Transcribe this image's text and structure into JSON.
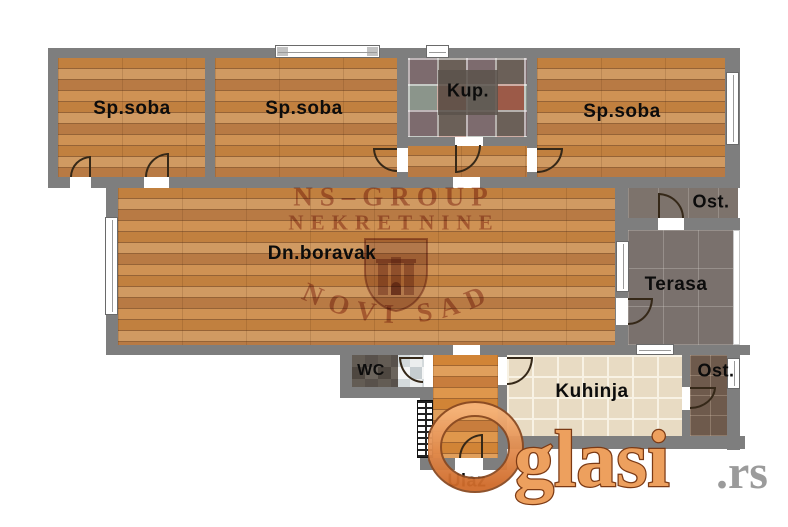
{
  "rooms": [
    {
      "id": "bedroom-1",
      "label": "Sp.soba"
    },
    {
      "id": "bedroom-2",
      "label": "Sp.soba"
    },
    {
      "id": "bathroom",
      "label": "Kup."
    },
    {
      "id": "bedroom-3",
      "label": "Sp.soba"
    },
    {
      "id": "living-room",
      "label": "Dn.boravak"
    },
    {
      "id": "storage-top",
      "label": "Ost."
    },
    {
      "id": "terrace",
      "label": "Terasa"
    },
    {
      "id": "wc",
      "label": "WC"
    },
    {
      "id": "kitchen",
      "label": "Kuhinja"
    },
    {
      "id": "storage-bottom",
      "label": "Ost."
    },
    {
      "id": "entrance",
      "label": "Ulaz"
    }
  ],
  "watermark": {
    "line1": "NS–GROUP",
    "line2": "NEKRETNINE",
    "line3": "NOVI SAD"
  },
  "logo": {
    "name": "glasi",
    "tld": ".rs"
  },
  "colors": {
    "wall": "#7e7e7e",
    "wood_floor": "#c68a52",
    "kitchen_tile": "#e8dbc3",
    "terrace_tile": "#7a716d",
    "storage_tile": "#6e5a4c",
    "watermark_maroon": "#a14a36",
    "logo_orange": "#e78a4e",
    "logo_gray": "#9b9b9b"
  }
}
